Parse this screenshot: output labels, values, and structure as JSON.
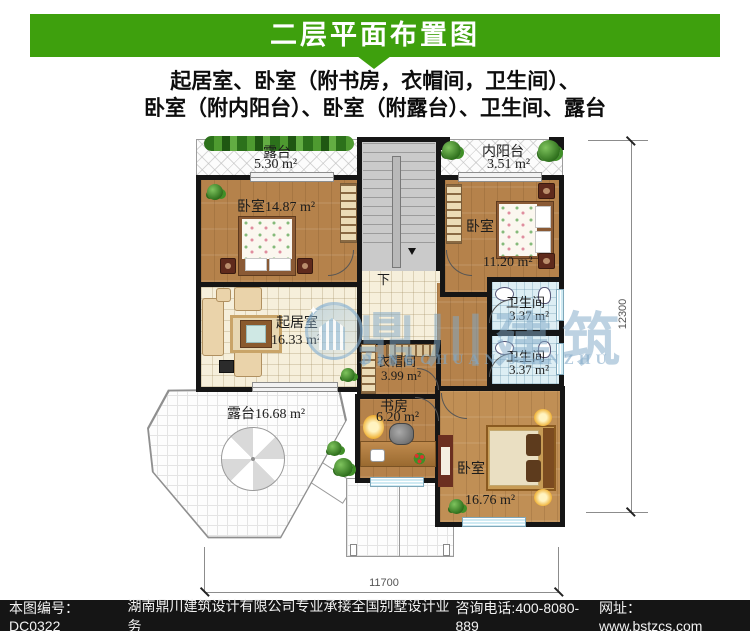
{
  "header": {
    "title": "二层平面布置图"
  },
  "subtitle": {
    "line1": "起居室、卧室（附书房，衣帽间，卫生间）、",
    "line2": "卧室（附内阳台）、卧室（附露台）、卫生间、露台"
  },
  "plan": {
    "rooms": {
      "terrace_top": {
        "name": "露台",
        "area": "5.30 m²"
      },
      "bedroom_left": {
        "label": "卧室14.87 m²"
      },
      "inner_balcony": {
        "name": "内阳台",
        "area": "3.51 m²"
      },
      "bedroom_right": {
        "name": "卧室",
        "area": "11.20 m²"
      },
      "living_room": {
        "name": "起居室",
        "area": "16.33 m²"
      },
      "bathroom_upper": {
        "name": "卫生间",
        "area": "3.37 m²"
      },
      "bathroom_lower": {
        "name": "卫生间",
        "area": "3.37 m²"
      },
      "cloakroom": {
        "name": "衣帽间",
        "area": "3.99 m²"
      },
      "study": {
        "name": "书房",
        "area": "6.20 m²"
      },
      "bedroom_bottom": {
        "name": "卧室",
        "area": "16.76 m²"
      },
      "terrace_octagon": {
        "label": "露台16.68 m²"
      }
    },
    "stair": {
      "down_label": "下"
    },
    "dimensions": {
      "bottom_width": "11700",
      "right_height": "12300"
    }
  },
  "watermark": {
    "name": "鼎川建筑",
    "sub": "DINGCHUAN JIANZHU",
    "sparkle": "✦"
  },
  "footer": {
    "drawing_no": "本图编号：DC0322",
    "company": "湖南鼎川建筑设计有限公司专业承接全国别墅设计业务",
    "phone": "咨询电话:400-8080-889",
    "website": "网址：www.bstzcs.com"
  },
  "colors": {
    "header_green": "#3EA00D",
    "wall_black": "#151515",
    "footer_bg": "#151515",
    "wood_floor": "#b5824b",
    "bath_tile": "#ddeef4"
  }
}
